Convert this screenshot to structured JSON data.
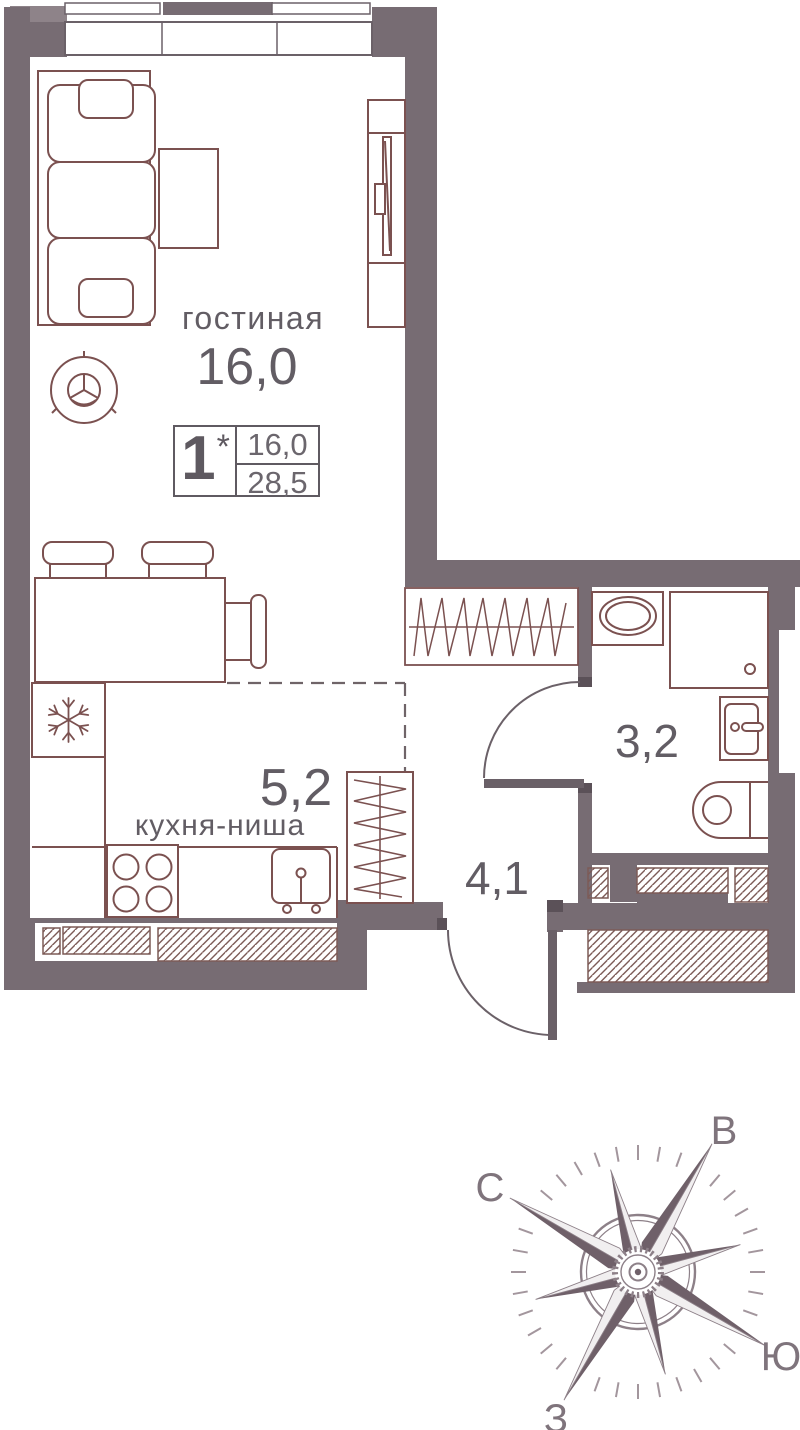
{
  "plan": {
    "info_box": {
      "rooms_count": "1",
      "asterisk": "*",
      "top_value": "16,0",
      "bottom_value": "28,5"
    },
    "labels": {
      "living_name": "гостиная",
      "living_area": "16,0",
      "kitchen_area": "5,2",
      "kitchen_name": "кухня-ниша",
      "bath_area": "3,2",
      "hall_area": "4,1"
    }
  },
  "compass": {
    "north_angle_deg": 150,
    "labels": {
      "north": "С",
      "east": "В",
      "south": "Ю",
      "west": "З"
    }
  },
  "colors": {
    "wall": "#776c73",
    "wall_dark": "#5b5158",
    "wall_light": "#8e8389",
    "furniture_line": "#7b5150",
    "frame_line": "#6b6168",
    "text": "#625d64",
    "hatch": "#7d5b57",
    "compass_dark": "#6f6069",
    "compass_light": "#f1eff0",
    "compass_outline": "#8d8088",
    "compass_tick": "#a3969d"
  }
}
